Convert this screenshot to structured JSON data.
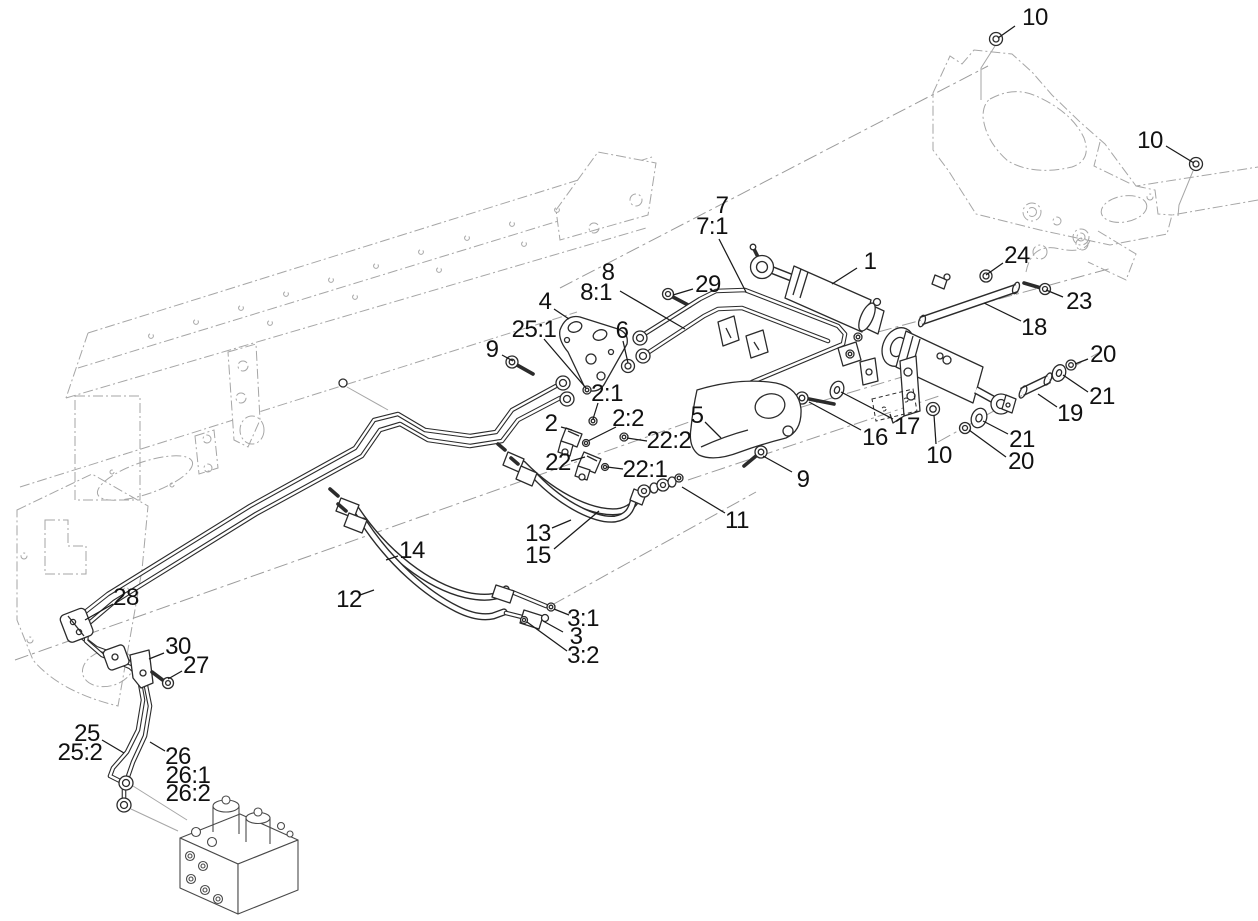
{
  "figure": {
    "kind": "exploded-parts-diagram",
    "background": "#ffffff",
    "line_color": "#2b2b2b",
    "phantom_color": "#a6a6a6",
    "leader_color": "#1a1a1a",
    "label_color": "#111111",
    "label_font_px": 24,
    "callouts": [
      {
        "part": "10",
        "x": 1035,
        "y": 18,
        "leader": [
          [
            1015,
            26
          ],
          [
            998,
            38
          ]
        ]
      },
      {
        "part": "10",
        "x": 1150,
        "y": 141,
        "leader": [
          [
            1166,
            146
          ],
          [
            1194,
            163
          ]
        ]
      },
      {
        "part": "7",
        "x": 722,
        "y": 206
      },
      {
        "part": "7:1",
        "x": 712,
        "y": 227,
        "leader": [
          [
            719,
            239
          ],
          [
            746,
            292
          ]
        ]
      },
      {
        "part": "1",
        "x": 870,
        "y": 262,
        "leader": [
          [
            857,
            268
          ],
          [
            832,
            284
          ]
        ]
      },
      {
        "part": "24",
        "x": 1017,
        "y": 256,
        "leader": [
          [
            1003,
            263
          ],
          [
            986,
            275
          ]
        ]
      },
      {
        "part": "23",
        "x": 1079,
        "y": 302,
        "leader": [
          [
            1063,
            297
          ],
          [
            1046,
            290
          ]
        ]
      },
      {
        "part": "18",
        "x": 1034,
        "y": 328,
        "leader": [
          [
            1021,
            321
          ],
          [
            984,
            303
          ]
        ]
      },
      {
        "part": "8",
        "x": 608,
        "y": 273
      },
      {
        "part": "8:1",
        "x": 596,
        "y": 293,
        "leader": [
          [
            620,
            291
          ],
          [
            685,
            329
          ]
        ]
      },
      {
        "part": "29",
        "x": 708,
        "y": 285,
        "leader": [
          [
            693,
            289
          ],
          [
            673,
            295
          ]
        ]
      },
      {
        "part": "4",
        "x": 545,
        "y": 302,
        "leader": [
          [
            554,
            309
          ],
          [
            569,
            319
          ]
        ]
      },
      {
        "part": "25:1",
        "x": 534,
        "y": 330,
        "leader": [
          [
            544,
            339
          ],
          [
            586,
            388
          ]
        ]
      },
      {
        "part": "6",
        "x": 622,
        "y": 331,
        "leader": [
          [
            623,
            341
          ],
          [
            628,
            363
          ]
        ]
      },
      {
        "part": "9",
        "x": 492,
        "y": 350,
        "leader": [
          [
            502,
            355
          ],
          [
            513,
            361
          ]
        ]
      },
      {
        "part": "2:1",
        "x": 607,
        "y": 394,
        "leader": [
          [
            598,
            403
          ],
          [
            593,
            419
          ]
        ]
      },
      {
        "part": "2",
        "x": 551,
        "y": 424,
        "leader": [
          [
            561,
            427
          ],
          [
            572,
            430
          ]
        ]
      },
      {
        "part": "2:2",
        "x": 628,
        "y": 419,
        "leader": [
          [
            616,
            427
          ],
          [
            588,
            441
          ]
        ]
      },
      {
        "part": "22:2",
        "x": 669,
        "y": 441,
        "leader": [
          [
            647,
            441
          ],
          [
            627,
            438
          ]
        ]
      },
      {
        "part": "5",
        "x": 697,
        "y": 416,
        "leader": [
          [
            705,
            422
          ],
          [
            721,
            438
          ]
        ]
      },
      {
        "part": "22",
        "x": 558,
        "y": 463,
        "leader": [
          [
            571,
            461
          ],
          [
            585,
            457
          ]
        ]
      },
      {
        "part": "22:1",
        "x": 645,
        "y": 470,
        "leader": [
          [
            623,
            469
          ],
          [
            607,
            467
          ]
        ]
      },
      {
        "part": "16",
        "x": 875,
        "y": 438,
        "leader": [
          [
            861,
            430
          ],
          [
            809,
            402
          ]
        ]
      },
      {
        "part": "17",
        "x": 907,
        "y": 427,
        "leader": [
          [
            893,
            419
          ],
          [
            841,
            392
          ]
        ]
      },
      {
        "part": "10",
        "x": 939,
        "y": 456,
        "leader": [
          [
            936,
            444
          ],
          [
            934,
            415
          ]
        ]
      },
      {
        "part": "21",
        "x": 1022,
        "y": 440,
        "leader": [
          [
            1008,
            434
          ],
          [
            983,
            421
          ]
        ]
      },
      {
        "part": "20",
        "x": 1021,
        "y": 462,
        "leader": [
          [
            1006,
            457
          ],
          [
            969,
            430
          ]
        ]
      },
      {
        "part": "19",
        "x": 1070,
        "y": 414,
        "leader": [
          [
            1057,
            407
          ],
          [
            1038,
            394
          ]
        ]
      },
      {
        "part": "20",
        "x": 1103,
        "y": 355,
        "leader": [
          [
            1088,
            359
          ],
          [
            1075,
            364
          ]
        ]
      },
      {
        "part": "21",
        "x": 1102,
        "y": 397,
        "leader": [
          [
            1088,
            392
          ],
          [
            1063,
            375
          ]
        ]
      },
      {
        "part": "9",
        "x": 803,
        "y": 480,
        "leader": [
          [
            792,
            472
          ],
          [
            763,
            456
          ]
        ]
      },
      {
        "part": "11",
        "x": 737,
        "y": 521,
        "leader": [
          [
            725,
            513
          ],
          [
            682,
            487
          ]
        ]
      },
      {
        "part": "13",
        "x": 538,
        "y": 534,
        "leader": [
          [
            552,
            528
          ],
          [
            571,
            520
          ]
        ]
      },
      {
        "part": "15",
        "x": 538,
        "y": 556,
        "leader": [
          [
            554,
            549
          ],
          [
            599,
            511
          ]
        ]
      },
      {
        "part": "14",
        "x": 412,
        "y": 551,
        "leader": [
          [
            398,
            556
          ],
          [
            386,
            560
          ]
        ]
      },
      {
        "part": "12",
        "x": 349,
        "y": 600,
        "leader": [
          [
            360,
            595
          ],
          [
            374,
            590
          ]
        ]
      },
      {
        "part": "3:1",
        "x": 583,
        "y": 619,
        "leader": [
          [
            569,
            615
          ],
          [
            554,
            609
          ]
        ]
      },
      {
        "part": "3",
        "x": 576,
        "y": 637,
        "leader": [
          [
            563,
            632
          ],
          [
            543,
            621
          ]
        ]
      },
      {
        "part": "3:2",
        "x": 583,
        "y": 656,
        "leader": [
          [
            567,
            651
          ],
          [
            527,
            622
          ]
        ]
      },
      {
        "part": "28",
        "x": 126,
        "y": 598,
        "leader": [
          [
            113,
            604
          ],
          [
            85,
            620
          ]
        ]
      },
      {
        "part": "30",
        "x": 178,
        "y": 647,
        "leader": [
          [
            164,
            653
          ],
          [
            149,
            659
          ]
        ]
      },
      {
        "part": "27",
        "x": 196,
        "y": 666,
        "leader": [
          [
            182,
            671
          ],
          [
            168,
            679
          ]
        ]
      },
      {
        "part": "25",
        "x": 87,
        "y": 734,
        "leader": [
          [
            102,
            740
          ],
          [
            124,
            753
          ]
        ]
      },
      {
        "part": "25:2",
        "x": 80,
        "y": 753
      },
      {
        "part": "26",
        "x": 178,
        "y": 757,
        "leader": [
          [
            165,
            751
          ],
          [
            150,
            742
          ]
        ]
      },
      {
        "part": "26:1",
        "x": 188,
        "y": 776
      },
      {
        "part": "26:2",
        "x": 188,
        "y": 794
      }
    ]
  }
}
